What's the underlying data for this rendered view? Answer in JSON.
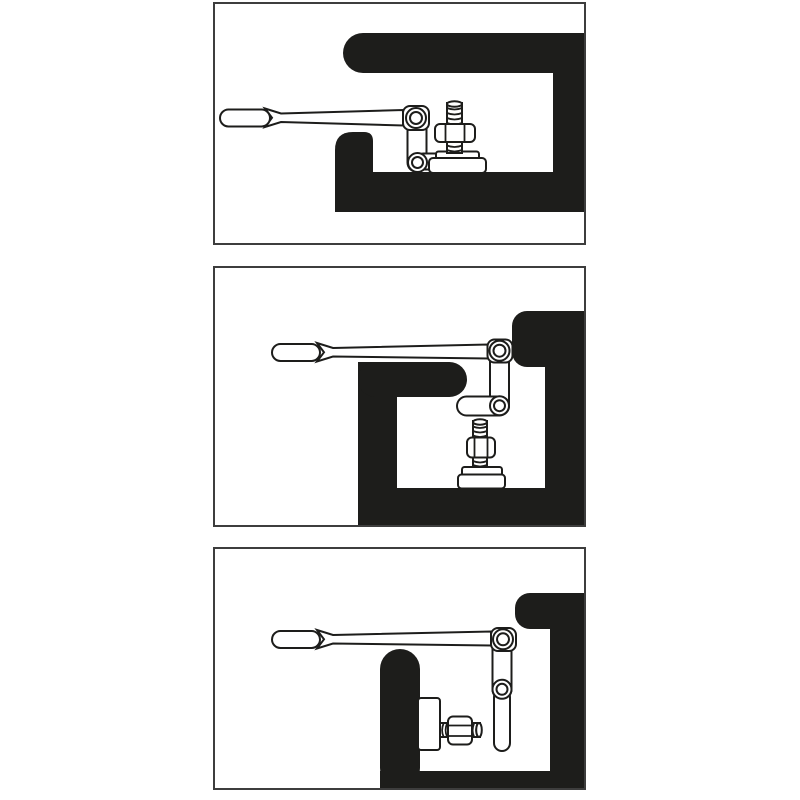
{
  "colors": {
    "ink": "#1d1d1b",
    "panel_border": "#3d3d3d",
    "panel_bg": "#ffffff"
  },
  "figure": {
    "kind": "three-step tool instruction diagram",
    "panels": [
      {
        "name": "step-1",
        "alt": "Hinged-head wrench horizontal, short socket on a vertical stud bolt with nut, inside an S-shaped black recess"
      },
      {
        "name": "step-2",
        "alt": "Hinged-link wrench with horizontal socket extension positioned above a vertical stud bolt with nut, inside a stepped black recess"
      },
      {
        "name": "step-3",
        "alt": "Hinged-link wrench with vertical socket extension beside a horizontal stud bolt with nut mounted on a black wall, inside a deep black recess"
      }
    ]
  }
}
